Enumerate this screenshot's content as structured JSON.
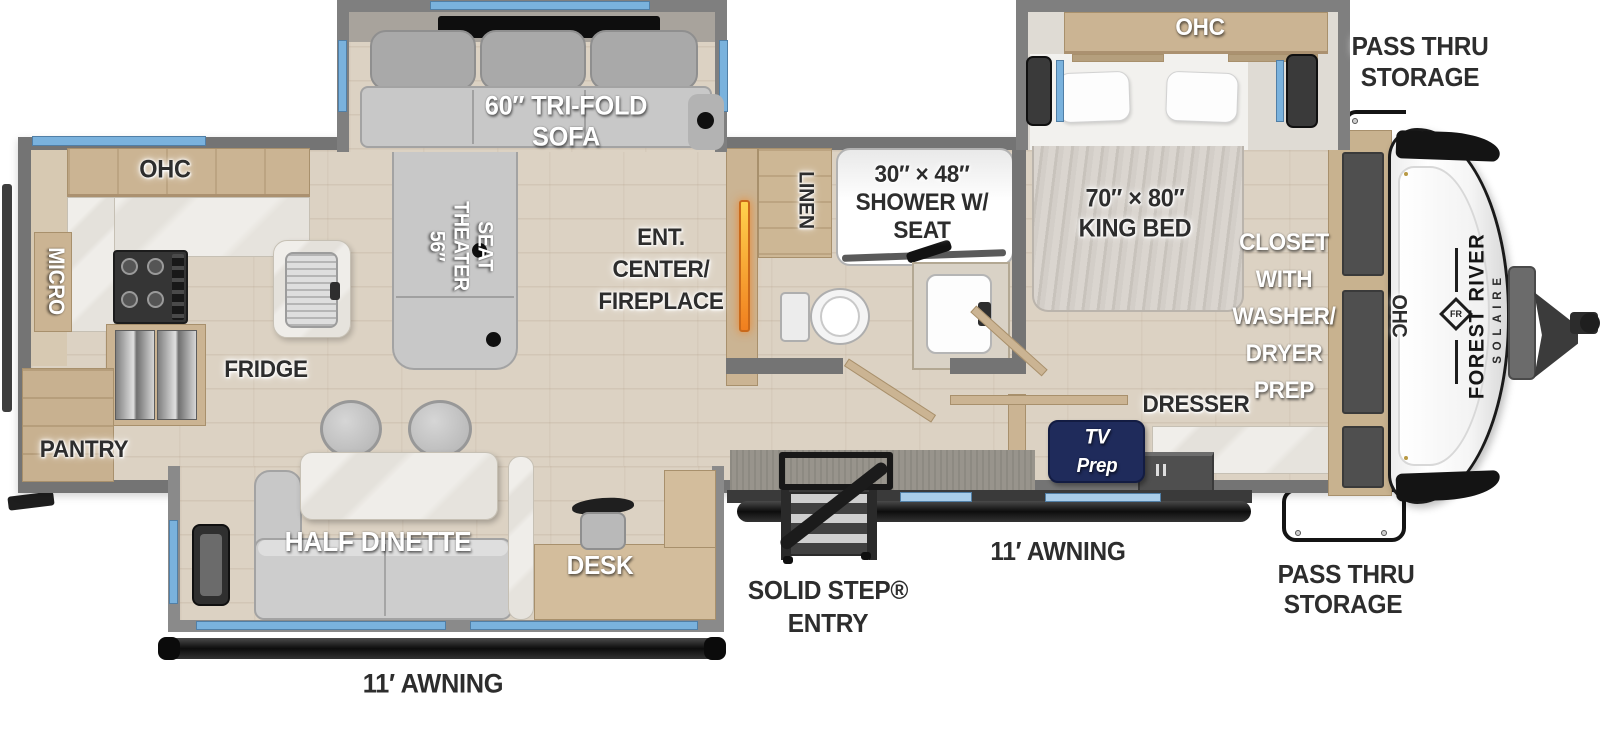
{
  "title": "Forest River Solaire Travel Trailer Floor Plan",
  "brand": {
    "manufacturer": "FOREST RIVER",
    "model": "SOLAIRE",
    "logo": "FR"
  },
  "labels": {
    "kitchen_ohc": "OHC",
    "micro": "MICRO",
    "fridge": "FRIDGE",
    "pantry": "PANTRY",
    "sofa": [
      "60″ TRI-FOLD",
      "SOFA"
    ],
    "theater_seat": [
      "56″",
      "THEATER",
      "SEAT"
    ],
    "ent_center": [
      "ENT.",
      "CENTER/",
      "FIREPLACE"
    ],
    "linen": "LINEN",
    "shower": [
      "30″ × 48″",
      "SHOWER W/",
      "SEAT"
    ],
    "king_bed": [
      "70″ × 80″",
      "KING BED"
    ],
    "bed_ohc": "OHC",
    "pass_thru_top": [
      "PASS THRU",
      "STORAGE"
    ],
    "closet": [
      "CLOSET",
      "WITH",
      "WASHER/",
      "DRYER",
      "PREP"
    ],
    "front_ohc": "OHC",
    "dresser": "DRESSER",
    "tv_prep": [
      "TV",
      "Prep"
    ],
    "half_dinette": "HALF DINETTE",
    "desk": "DESK",
    "awning_bottom": "11′ AWNING",
    "awning_right": "11′ AWNING",
    "solid_step": [
      "SOLID STEP®",
      "ENTRY"
    ],
    "pass_thru_bottom": [
      "PASS THRU",
      "STORAGE"
    ]
  },
  "colors": {
    "wall_gray": "#747474",
    "floor_tan": "#dcd2c3",
    "cabinet_tan": "#cbb493",
    "window_blue": "#7ab2dd",
    "counter_marble": "#eceae6",
    "sofa_gray": "#c8c8c8",
    "tv_prep_navy": "#1f2b5b",
    "fireplace_orange": "#f2801e",
    "accent_black": "#1a1a1a"
  }
}
